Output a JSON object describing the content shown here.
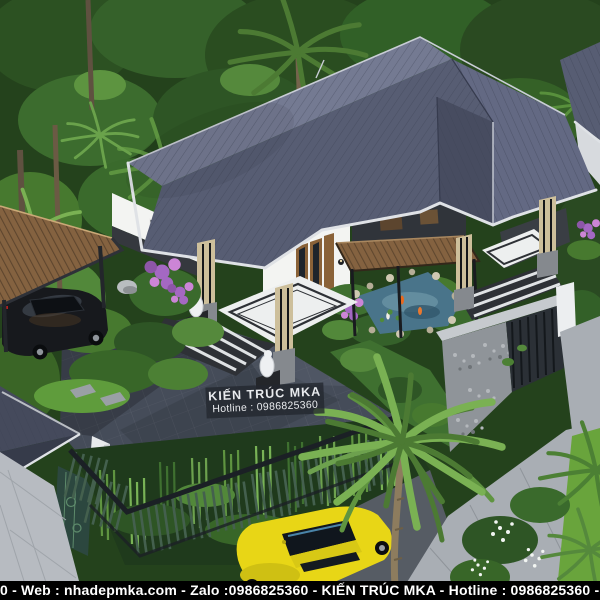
{
  "scene": {
    "subject": "Aerial 3D architectural rendering of a modern single-storey villa: dark slate hip roof, wood slat pergolas, koi pond garden, carport with black sedan, dark paved courtyard, green slat fence with bamboo, gabion stone wall, palm trees and a yellow sports car on the street",
    "watermark": {
      "line1": "KIẾN TRÚC MKA",
      "line2": "Hotline : 0986825360"
    },
    "banner": {
      "text": "0 - Web : nhadepmka.com - Zalo :0986825360 - KIẾN TRÚC MKA - Hotline : 0986825360 - Web : nhadepm-"
    }
  },
  "colors": {
    "jungle_base": "#24421c",
    "roof_main": "#575d73",
    "roof_light": "#747a92",
    "roof_dark": "#474c60",
    "roof_right": "#636983",
    "tile_line": "#3d4254",
    "fascia": "#dfe2e6",
    "wall_white": "#f3f4f2",
    "wall_shadow": "#d7dade",
    "stone_dark": "#35383e",
    "wood": "#846240",
    "wood_dark": "#57412b",
    "column_stone": "#cdbf9b",
    "patio_white": "#edefef",
    "step_dark": "#2e3136",
    "courtyard": "#454c59",
    "pavement": "#b7bbc1",
    "sidewalk": "#a9aeb4",
    "grass": "#69a43c",
    "pond": "#49748a",
    "flower_purple": "#a468c2",
    "flower_pink": "#cc85d6",
    "fence_green": "#44604e",
    "fence_dark": "#1b2025",
    "bamboo": "#6da14e",
    "car_yellow": "#e8d616",
    "car_black": "#17191d",
    "stone_wall": "#8f9499",
    "banner_bg": "#000000",
    "text_white": "#ffffff",
    "watermark_bg": "rgba(35,38,46,0.78)"
  }
}
